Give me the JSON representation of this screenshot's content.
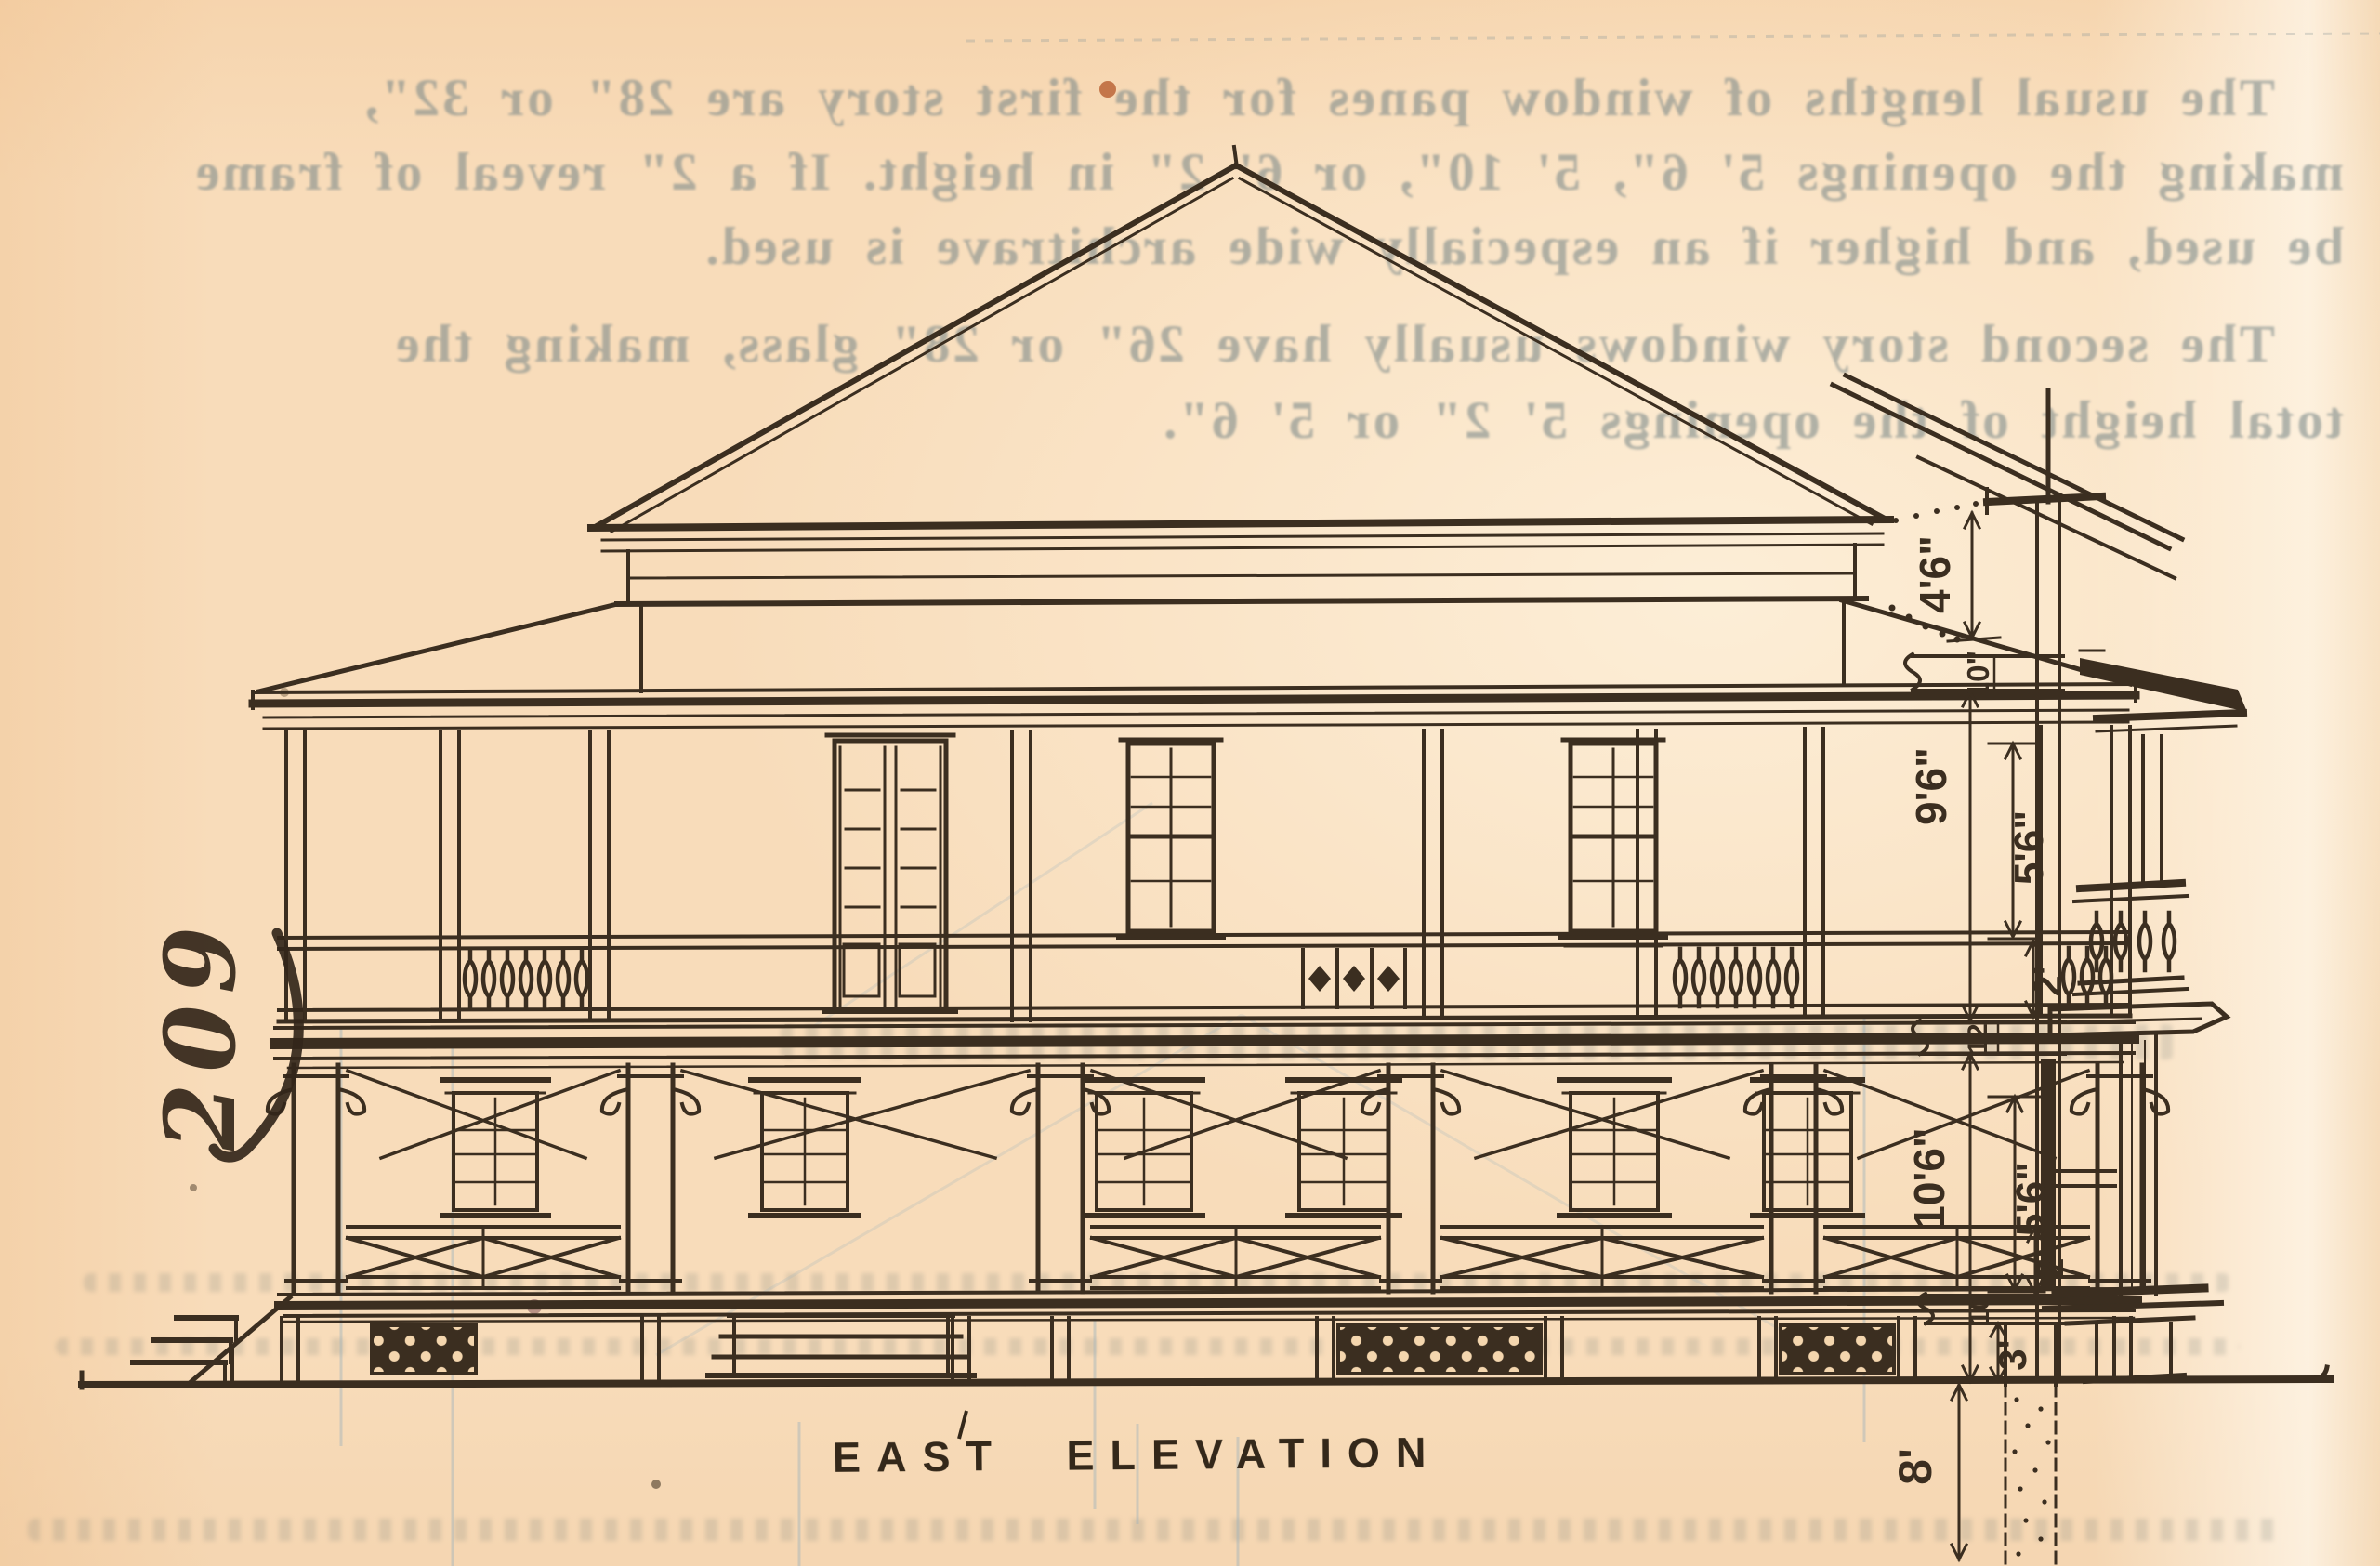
{
  "page": {
    "caption": "EAST ELEVATION",
    "handwritten_figure_number": "209",
    "paper_color": "#f8dcba",
    "ink_color": "#3b2e20",
    "ghost_ink_color": "#7a8888"
  },
  "ghost_text": {
    "paragraph1_lines": [
      "The usual lengths of window panes for the first story are 28\" or 32\",",
      "making the openings 5' 6\", 5' 10\", or 6' 2\" in height. If a 2\" reveal of frame",
      "be used, and higher if an especially wide architrave is used."
    ],
    "paragraph2_lines": [
      "The second story windows usually have 26\" or 28\" glass, making the",
      "total height of the openings 5' 2\" or 5' 6\"."
    ]
  },
  "dimension_annotations": {
    "labels": [
      "4'6\"",
      "10\"",
      "9'6\"",
      "5'6\"",
      "2'",
      "12",
      "10'6\"",
      "5'6\"",
      "2'",
      "10",
      "3'",
      "8'"
    ]
  }
}
